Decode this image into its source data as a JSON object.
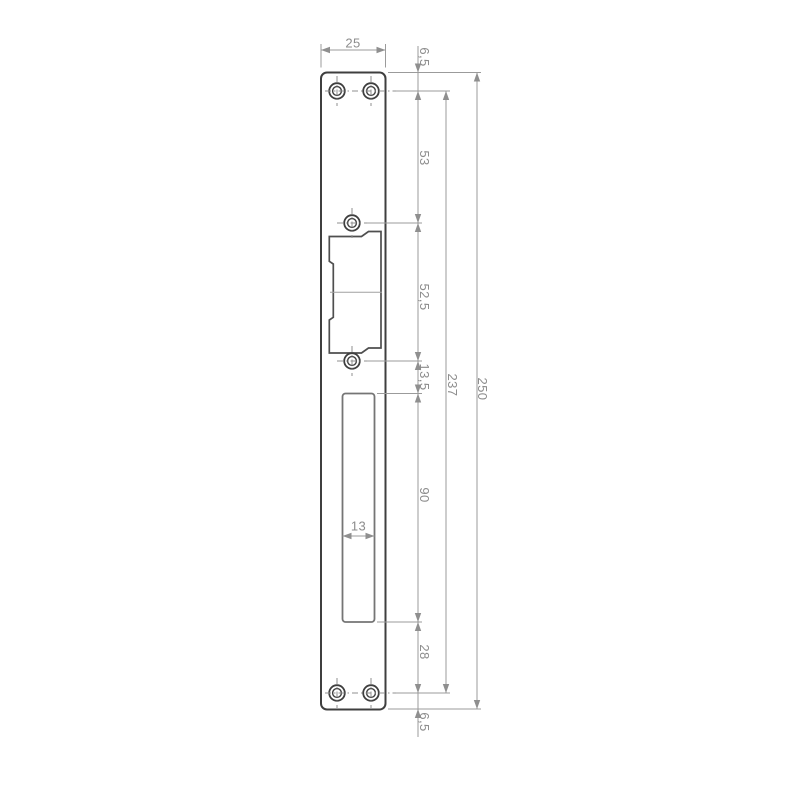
{
  "drawing": {
    "kind": "technical-dimension-drawing",
    "labels": {
      "plate_width": "25",
      "top_edge_to_top_holes": "6,5",
      "top_holes_to_latch_top_hole": "53",
      "latch_holes_spacing": "52,5",
      "latch_bottom_hole_to_cutout": "13,5",
      "cutout_height": "90",
      "cutout_width": "13",
      "cutout_to_bottom_holes": "28",
      "bottom_holes_to_edge": "6,5",
      "top_to_bottom_holes": "237",
      "overall_height": "250"
    },
    "colors": {
      "background": "#ffffff",
      "plate_outline": "#3f3f3f",
      "latch_cutout_outline": "#4f4f4f",
      "bolt_cutout_outline": "#757575",
      "dimension_lines": "#9b9b9b",
      "dimension_text": "#8c8c8c"
    }
  }
}
